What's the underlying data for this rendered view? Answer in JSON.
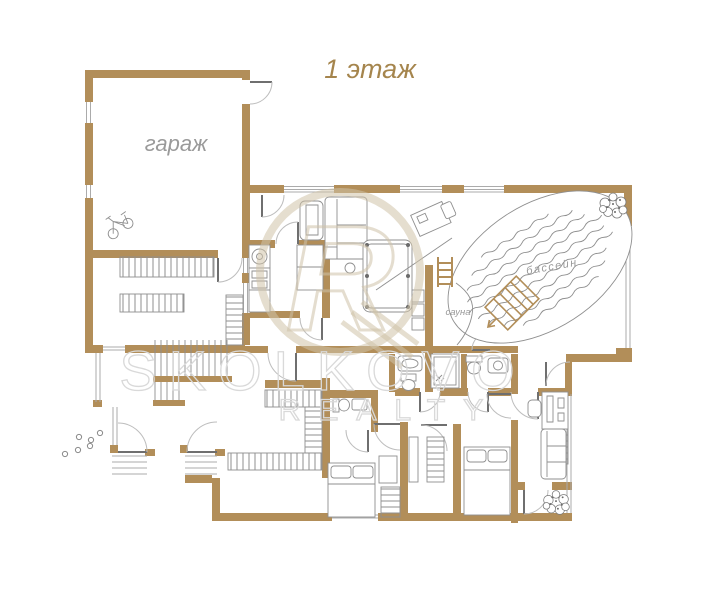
{
  "title": "1 этаж",
  "rooms": {
    "garage": "гараж",
    "pool": "бассейн",
    "sauna": "сауна"
  },
  "watermark": {
    "line1": "SKOLKOVO",
    "line2": "REALTY",
    "emblem_letter": "R"
  },
  "colors": {
    "wall": "#b28e59",
    "wall_light": "#cbae80",
    "furniture_line": "#8f8f8f",
    "window_line": "#ababab",
    "door_line": "#6f6f6f",
    "arc_line": "#bdbdbd",
    "room_label": "#9a9a9a",
    "title_text": "#a5854d",
    "watermark_line": "#d9d9d9",
    "emblem_line": "#cfc2a8"
  },
  "icons": [
    "plant-icon",
    "bicycle-icon",
    "lounge-chair-icon",
    "pool-ladder-icon",
    "washing-machine-icon",
    "shower-icon",
    "toilet-icon",
    "sink-icon",
    "bed-icon",
    "sofa-icon",
    "armchair-icon",
    "desk-icon",
    "billiard-table-icon",
    "stairs-icon",
    "stepping-stones-icon",
    "wardrobe-icon",
    "radiator-icon"
  ]
}
